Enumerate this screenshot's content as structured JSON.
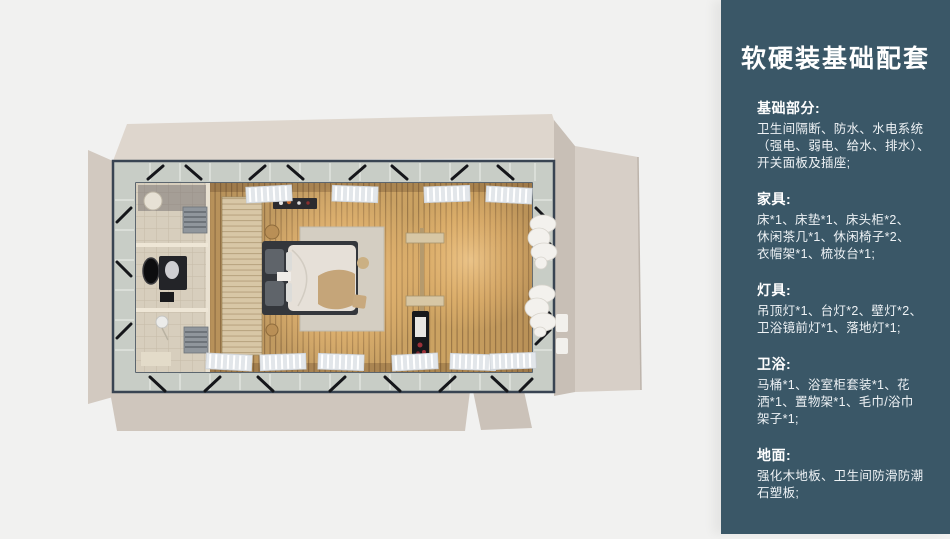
{
  "panel": {
    "title": "软硬装基础配套",
    "accent_color": "#3a5767",
    "text_color": "#ffffff",
    "sections": [
      {
        "heading": "基础部分:",
        "lines": [
          "卫生间隔断、防水、水电系统",
          "（强电、弱电、给水、排水）、",
          "开关面板及插座;"
        ]
      },
      {
        "heading": "家具:",
        "lines": [
          "床*1、床垫*1、床头柜*2、",
          "休闲茶几*1、休闲椅子*2、",
          "衣帽架*1、梳妆台*1;"
        ]
      },
      {
        "heading": "灯具:",
        "lines": [
          "吊顶灯*1、台灯*2、壁灯*2、",
          "卫浴镜前灯*1、落地灯*1;"
        ]
      },
      {
        "heading": "卫浴:",
        "lines": [
          "马桶*1、浴室柜套装*1、花",
          "洒*1、置物架*1、毛巾/浴巾",
          "架子*1;"
        ]
      },
      {
        "heading": "地面:",
        "lines": [
          "强化木地板、卫生间防滑防潮",
          "石塑板;"
        ]
      }
    ]
  },
  "floorplan": {
    "colors": {
      "background": "#f1f1f0",
      "flap_top": "#ded6cd",
      "flap_left": "#d2c9c0",
      "flap_right": "#d7cfc7",
      "flap_right_edge": "#c8bfb6",
      "flap_bottom": "#cfc6bd",
      "steel_frame": "#394452",
      "glass_band": "#c8cdc6",
      "bathroom_tile": "#d7cebd",
      "wood_floor": "#c49c62",
      "headboard_wood": "#d8c7a6",
      "rug": "#d4cec2",
      "bed_frame": "#34373c",
      "bed_duvet": "#e6e0d8",
      "pillow": "#5f646a",
      "throw_blanket": "#c3a174",
      "curtain": "#f3f1ed",
      "blind": "#e2e6ea",
      "brace": "#15161a"
    }
  }
}
